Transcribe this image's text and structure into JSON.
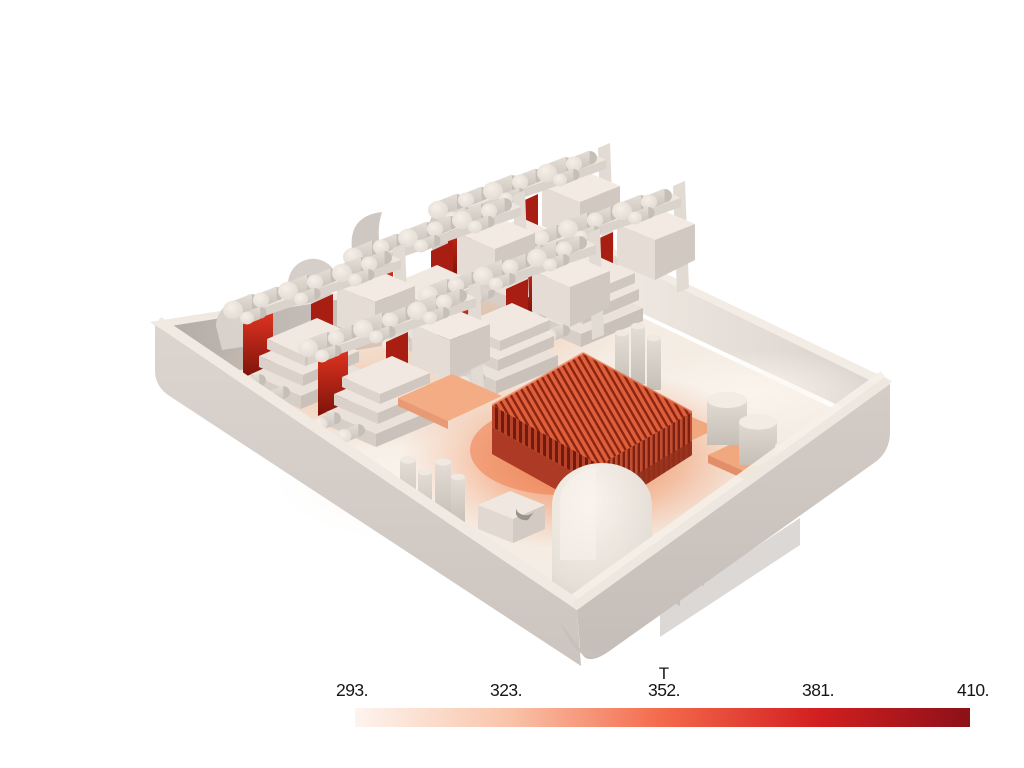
{
  "window": {
    "background": "#ffffff",
    "description": "3D thermal render viewport with bottom color legend"
  },
  "colorbar": {
    "title": "T",
    "tick_labels": [
      "293.",
      "323.",
      "352.",
      "381.",
      "410."
    ],
    "tick_values": [
      293,
      323,
      352,
      381,
      410
    ],
    "min": 293,
    "max": 410,
    "gradient_stops": [
      "#fdf4ef",
      "#f9c4a9",
      "#f4694b",
      "#d31f20",
      "#8c1118"
    ],
    "text_color": "#161616"
  },
  "chart_data": {
    "type": "heatmap",
    "title": "T",
    "legend_position": "bottom",
    "colorbar": {
      "orientation": "horizontal",
      "min": 293,
      "max": 410,
      "ticks": [
        293,
        323,
        352,
        381,
        410
      ],
      "tick_labels": [
        "293.",
        "323.",
        "352.",
        "381.",
        "410."
      ],
      "colormap_stops": [
        "#fdf4ef",
        "#f9c4a9",
        "#f4694b",
        "#d31f20",
        "#8c1118"
      ]
    },
    "rendered_scene": "3D thermal simulation of an open electronics enclosure: hottest parts are the finned heatsink block and vertical plates between card modules (dark red); board pads glow salmon; shell and components near ambient (off-white)"
  },
  "scene": {
    "objects": [
      "enclosure-shell",
      "enclosure-floor",
      "card-module x6",
      "hot-plate-red",
      "cpu-heatsink-finned",
      "dome-capacitor",
      "small-capacitors",
      "vent-slats",
      "salmon-pads",
      "fan-shrouds",
      "notched-box"
    ],
    "colors": {
      "shell_outer": "#d6cfc9",
      "shell_inner_shadow": "#b7b0aa",
      "floor": "#f5ede4",
      "hot_plate_red": "#d0281a",
      "heatsink_fin_bright": "#de5f3b",
      "heatsink_fin_dark": "#8a2410",
      "pad_salmon": "#f2a87f",
      "floor_glow": "#ee7e4e"
    }
  }
}
